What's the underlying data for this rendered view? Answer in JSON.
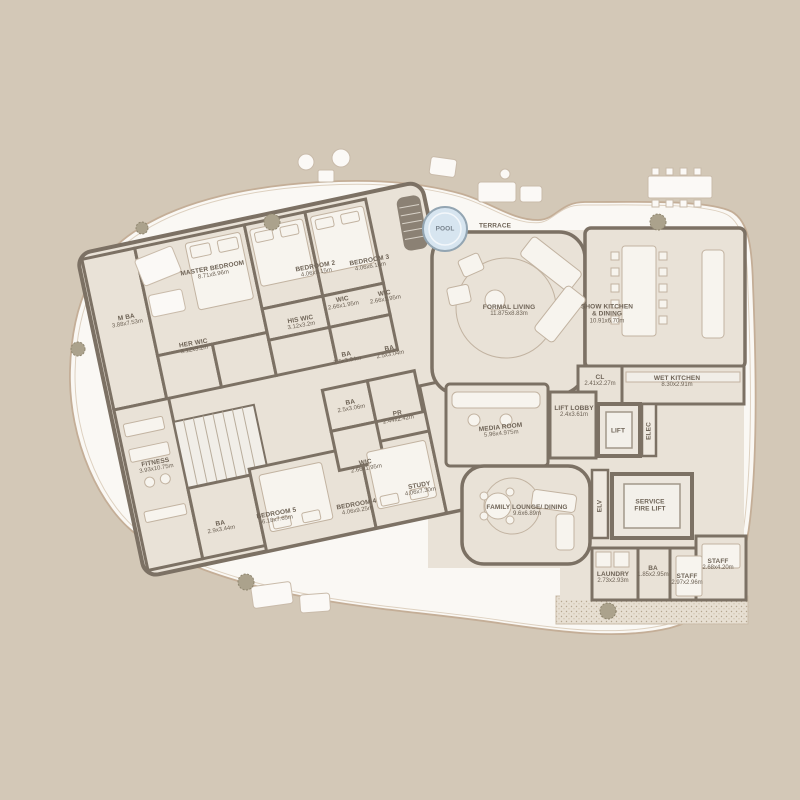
{
  "scene": {
    "type": "residential floor plan",
    "outdoor_labels": {
      "pool": "POOL",
      "terrace": "TERRACE"
    }
  },
  "colors": {
    "background": "#d3c8b7",
    "terrace": "#faf8f4",
    "room_fill": "#e9e2d7",
    "wall": "#7c7164",
    "pool_fill": "#d7e5f0",
    "pool_stroke": "#93a5b2",
    "label_text": "#6e6356",
    "furniture_line": "#c2b3a1"
  },
  "rooms": [
    {
      "id": "master-bedroom",
      "label": "MASTER BEDROOM",
      "dims": "8.71x8.96m"
    },
    {
      "id": "m-ba",
      "label": "M BA",
      "dims": "3.88x7.53m"
    },
    {
      "id": "her-wic",
      "label": "HER WIC",
      "dims": "3.12x3.2m"
    },
    {
      "id": "his-wic",
      "label": "HIS WIC",
      "dims": "3.12x3.2m"
    },
    {
      "id": "bedroom-2",
      "label": "BEDROOM 2",
      "dims": "4.06x9.15m"
    },
    {
      "id": "bedroom-3",
      "label": "BEDROOM 3",
      "dims": "4.06x6.16m"
    },
    {
      "id": "wic-bedroom-2",
      "label": "WIC",
      "dims": "2.66x1.95m"
    },
    {
      "id": "wic-bedroom-3",
      "label": "WIC",
      "dims": "2.66x1.95m"
    },
    {
      "id": "ba-bedroom-2",
      "label": "BA",
      "dims": "2.5x3.04m"
    },
    {
      "id": "ba-bedroom-3",
      "label": "BA",
      "dims": "2.5x3.04m"
    },
    {
      "id": "ba-hall",
      "label": "BA",
      "dims": "2.5x3.06m"
    },
    {
      "id": "pr",
      "label": "PR",
      "dims": "2.44x2.42m"
    },
    {
      "id": "wic-bedroom-4",
      "label": "WIC",
      "dims": "2.66x1.95m"
    },
    {
      "id": "study",
      "label": "STUDY",
      "dims": "4.06x7.30m"
    },
    {
      "id": "bedroom-4",
      "label": "BEDROOM 4",
      "dims": "4.06x9.25m"
    },
    {
      "id": "bedroom-5",
      "label": "BEDROOM 5",
      "dims": "6.18x7.65m"
    },
    {
      "id": "ba-bedroom-5",
      "label": "BA",
      "dims": "2.9x3.44m"
    },
    {
      "id": "fitness",
      "label": "FITNESS",
      "dims": "3.93x10.75m"
    },
    {
      "id": "formal-living",
      "label": "FORMAL LIVING",
      "dims": "11.875x8.83m"
    },
    {
      "id": "show-kitchen",
      "label": "SHOW KITCHEN\n& DINING",
      "dims": "10.91x6.70m"
    },
    {
      "id": "cl",
      "label": "CL",
      "dims": "2.41x2.27m"
    },
    {
      "id": "wet-kitchen",
      "label": "WET KITCHEN",
      "dims": "8.30x2.91m"
    },
    {
      "id": "media-room",
      "label": "MEDIA ROOM",
      "dims": "5.96x4.975m"
    },
    {
      "id": "lift-lobby",
      "label": "LIFT LOBBY",
      "dims": "2.4x3.61m"
    },
    {
      "id": "lift",
      "label": "LIFT",
      "dims": ""
    },
    {
      "id": "elec",
      "label": "ELEC",
      "dims": ""
    },
    {
      "id": "family-lounge",
      "label": "FAMILY LOUNGE/ DINING",
      "dims": "9.6x6.89m"
    },
    {
      "id": "elv",
      "label": "ELV",
      "dims": ""
    },
    {
      "id": "service-fire-lift",
      "label": "SERVICE\nFIRE LIFT",
      "dims": ""
    },
    {
      "id": "laundry",
      "label": "LAUNDRY",
      "dims": "2.73x2.93m"
    },
    {
      "id": "ba-staff",
      "label": "BA",
      "dims": "1.85x2.95m"
    },
    {
      "id": "staff-1",
      "label": "STAFF",
      "dims": "2.97x2.96m"
    },
    {
      "id": "staff-2",
      "label": "STAFF",
      "dims": "2.68x4.20m"
    },
    {
      "id": "pool",
      "label": "POOL",
      "dims": ""
    },
    {
      "id": "terrace",
      "label": "TERRACE",
      "dims": ""
    }
  ]
}
